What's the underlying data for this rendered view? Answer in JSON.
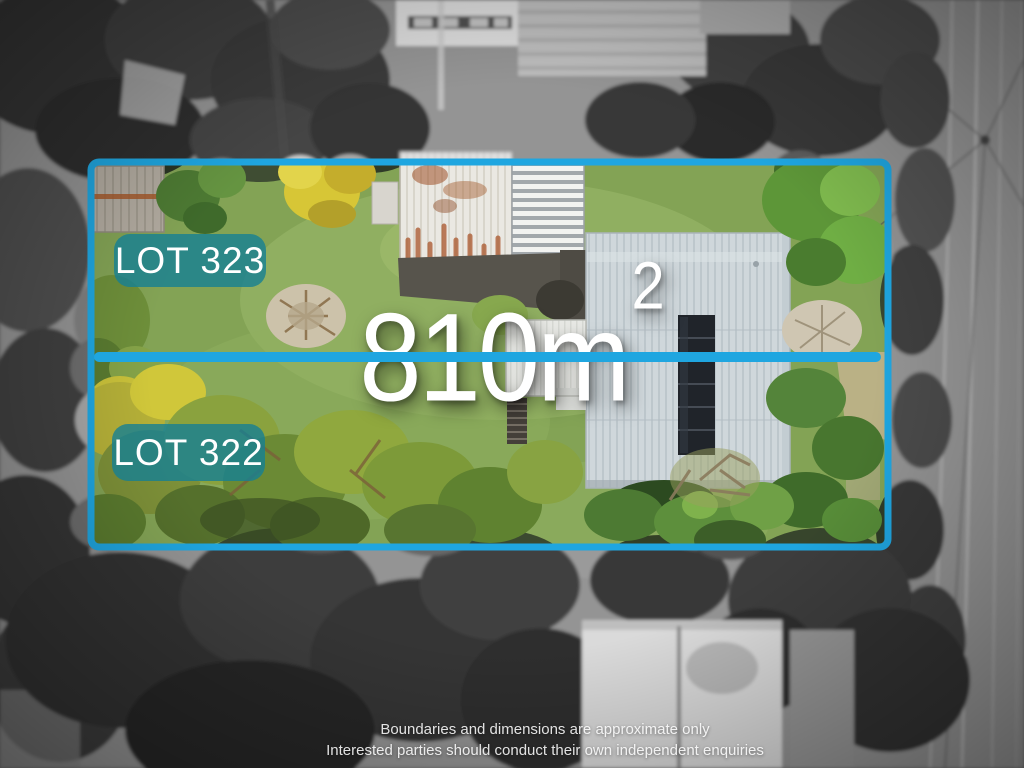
{
  "overlay": {
    "area_label": {
      "text": "810m",
      "superscript": "2"
    },
    "badges": [
      {
        "label": "LOT 323"
      },
      {
        "label": "LOT 322"
      }
    ],
    "disclaimer": {
      "line1": "Boundaries and dimensions are approximate only",
      "line2": "Interested parties should conduct their own independent enquiries"
    },
    "colors": {
      "boundary_line": "#1FA6E0",
      "badge_background": "rgba(21,127,147,0.8)",
      "label_text": "#FFFFFF"
    }
  }
}
